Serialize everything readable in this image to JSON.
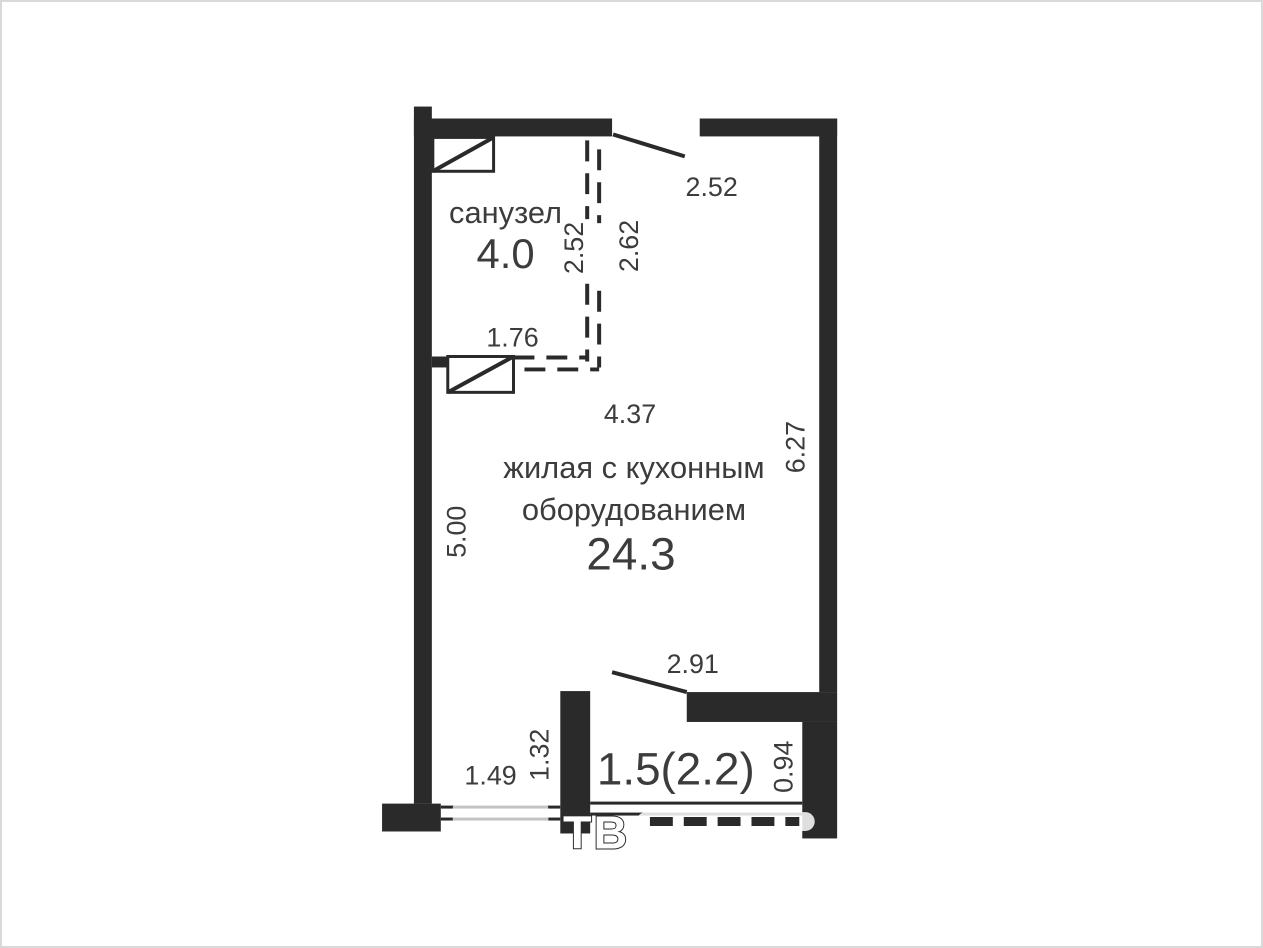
{
  "colors": {
    "wall": "#2a2a2a",
    "text": "#3c3c3c",
    "frame": "#d9d9d9",
    "wm": "#ffffff"
  },
  "plan": {
    "rooms": {
      "bathroom": {
        "label": "санузел",
        "area": "4.0"
      },
      "living": {
        "label_line1": "жилая с кухонным",
        "label_line2": "оборудованием",
        "area": "24.3"
      },
      "balcony": {
        "area": "1.5(2.2)"
      }
    },
    "dimensions": {
      "entry_opening": "2.52",
      "bath_partition_length": "2.52",
      "bath_inner_wall": "2.62",
      "partition_width": "1.76",
      "living_width": "4.37",
      "living_length_right": "6.27",
      "living_length_left": "5.00",
      "balcony_section_width": "2.91",
      "balcony_divider_wall": "1.32",
      "window_width": "1.49",
      "balcony_depth": "0.94"
    },
    "watermark": "ТВ"
  }
}
